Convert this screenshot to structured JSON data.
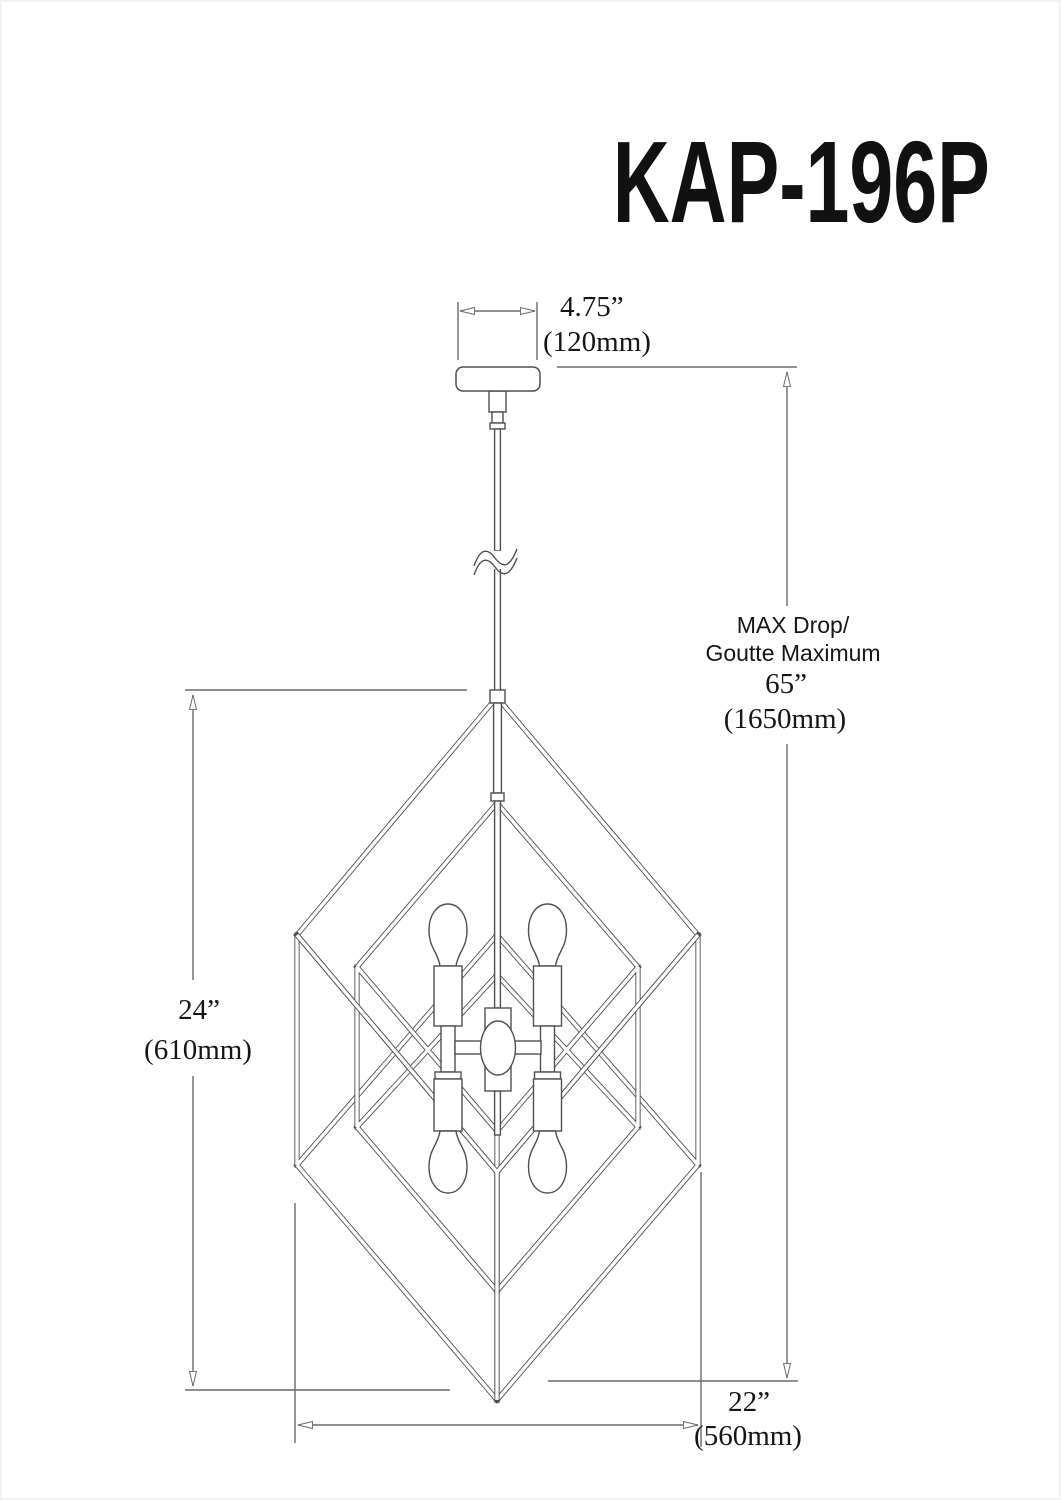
{
  "title": "KAP-196P",
  "annotations": {
    "canopy_width_in": "4.75”",
    "canopy_width_mm": "(120mm)",
    "max_drop_label_en": "MAX Drop/",
    "max_drop_label_fr": "Goutte Maximum",
    "max_drop_in": "65”",
    "max_drop_mm": "(1650mm)",
    "fixture_height_in": "24”",
    "fixture_height_mm": "(610mm)",
    "fixture_width_in": "22”",
    "fixture_width_mm": "(560mm)"
  },
  "colors": {
    "line_gray": "#4f4f4f",
    "dimension_gray": "#6a6a6a",
    "text_black": "#161616"
  }
}
